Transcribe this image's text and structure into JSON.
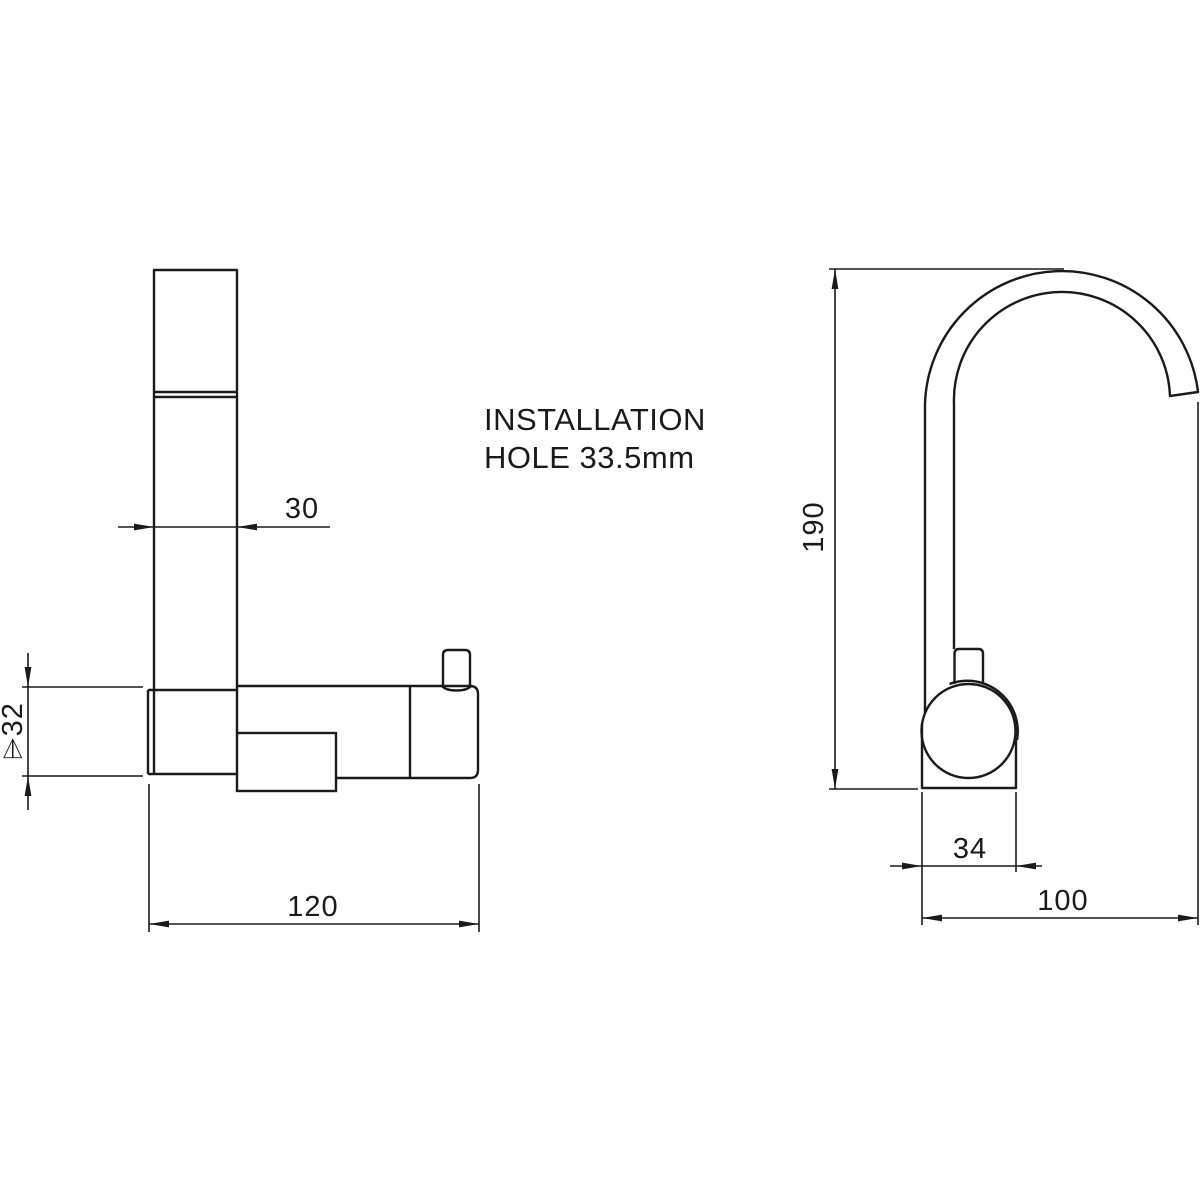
{
  "drawing": {
    "type": "technical-dimension-drawing",
    "subject": "folding kitchen faucet tap",
    "colors": {
      "line": "#1a1a1a",
      "background": "#ffffff"
    },
    "annotation": {
      "line1": "INSTALLATION",
      "line2": "HOLE 33.5mm"
    },
    "side_view": {
      "dim_spout_tube_width": "30",
      "dim_socket_diameter": "⌲32",
      "dim_body_length": "120"
    },
    "front_view": {
      "dim_overall_height": "190",
      "dim_base_width": "34",
      "dim_spout_reach": "100"
    }
  }
}
